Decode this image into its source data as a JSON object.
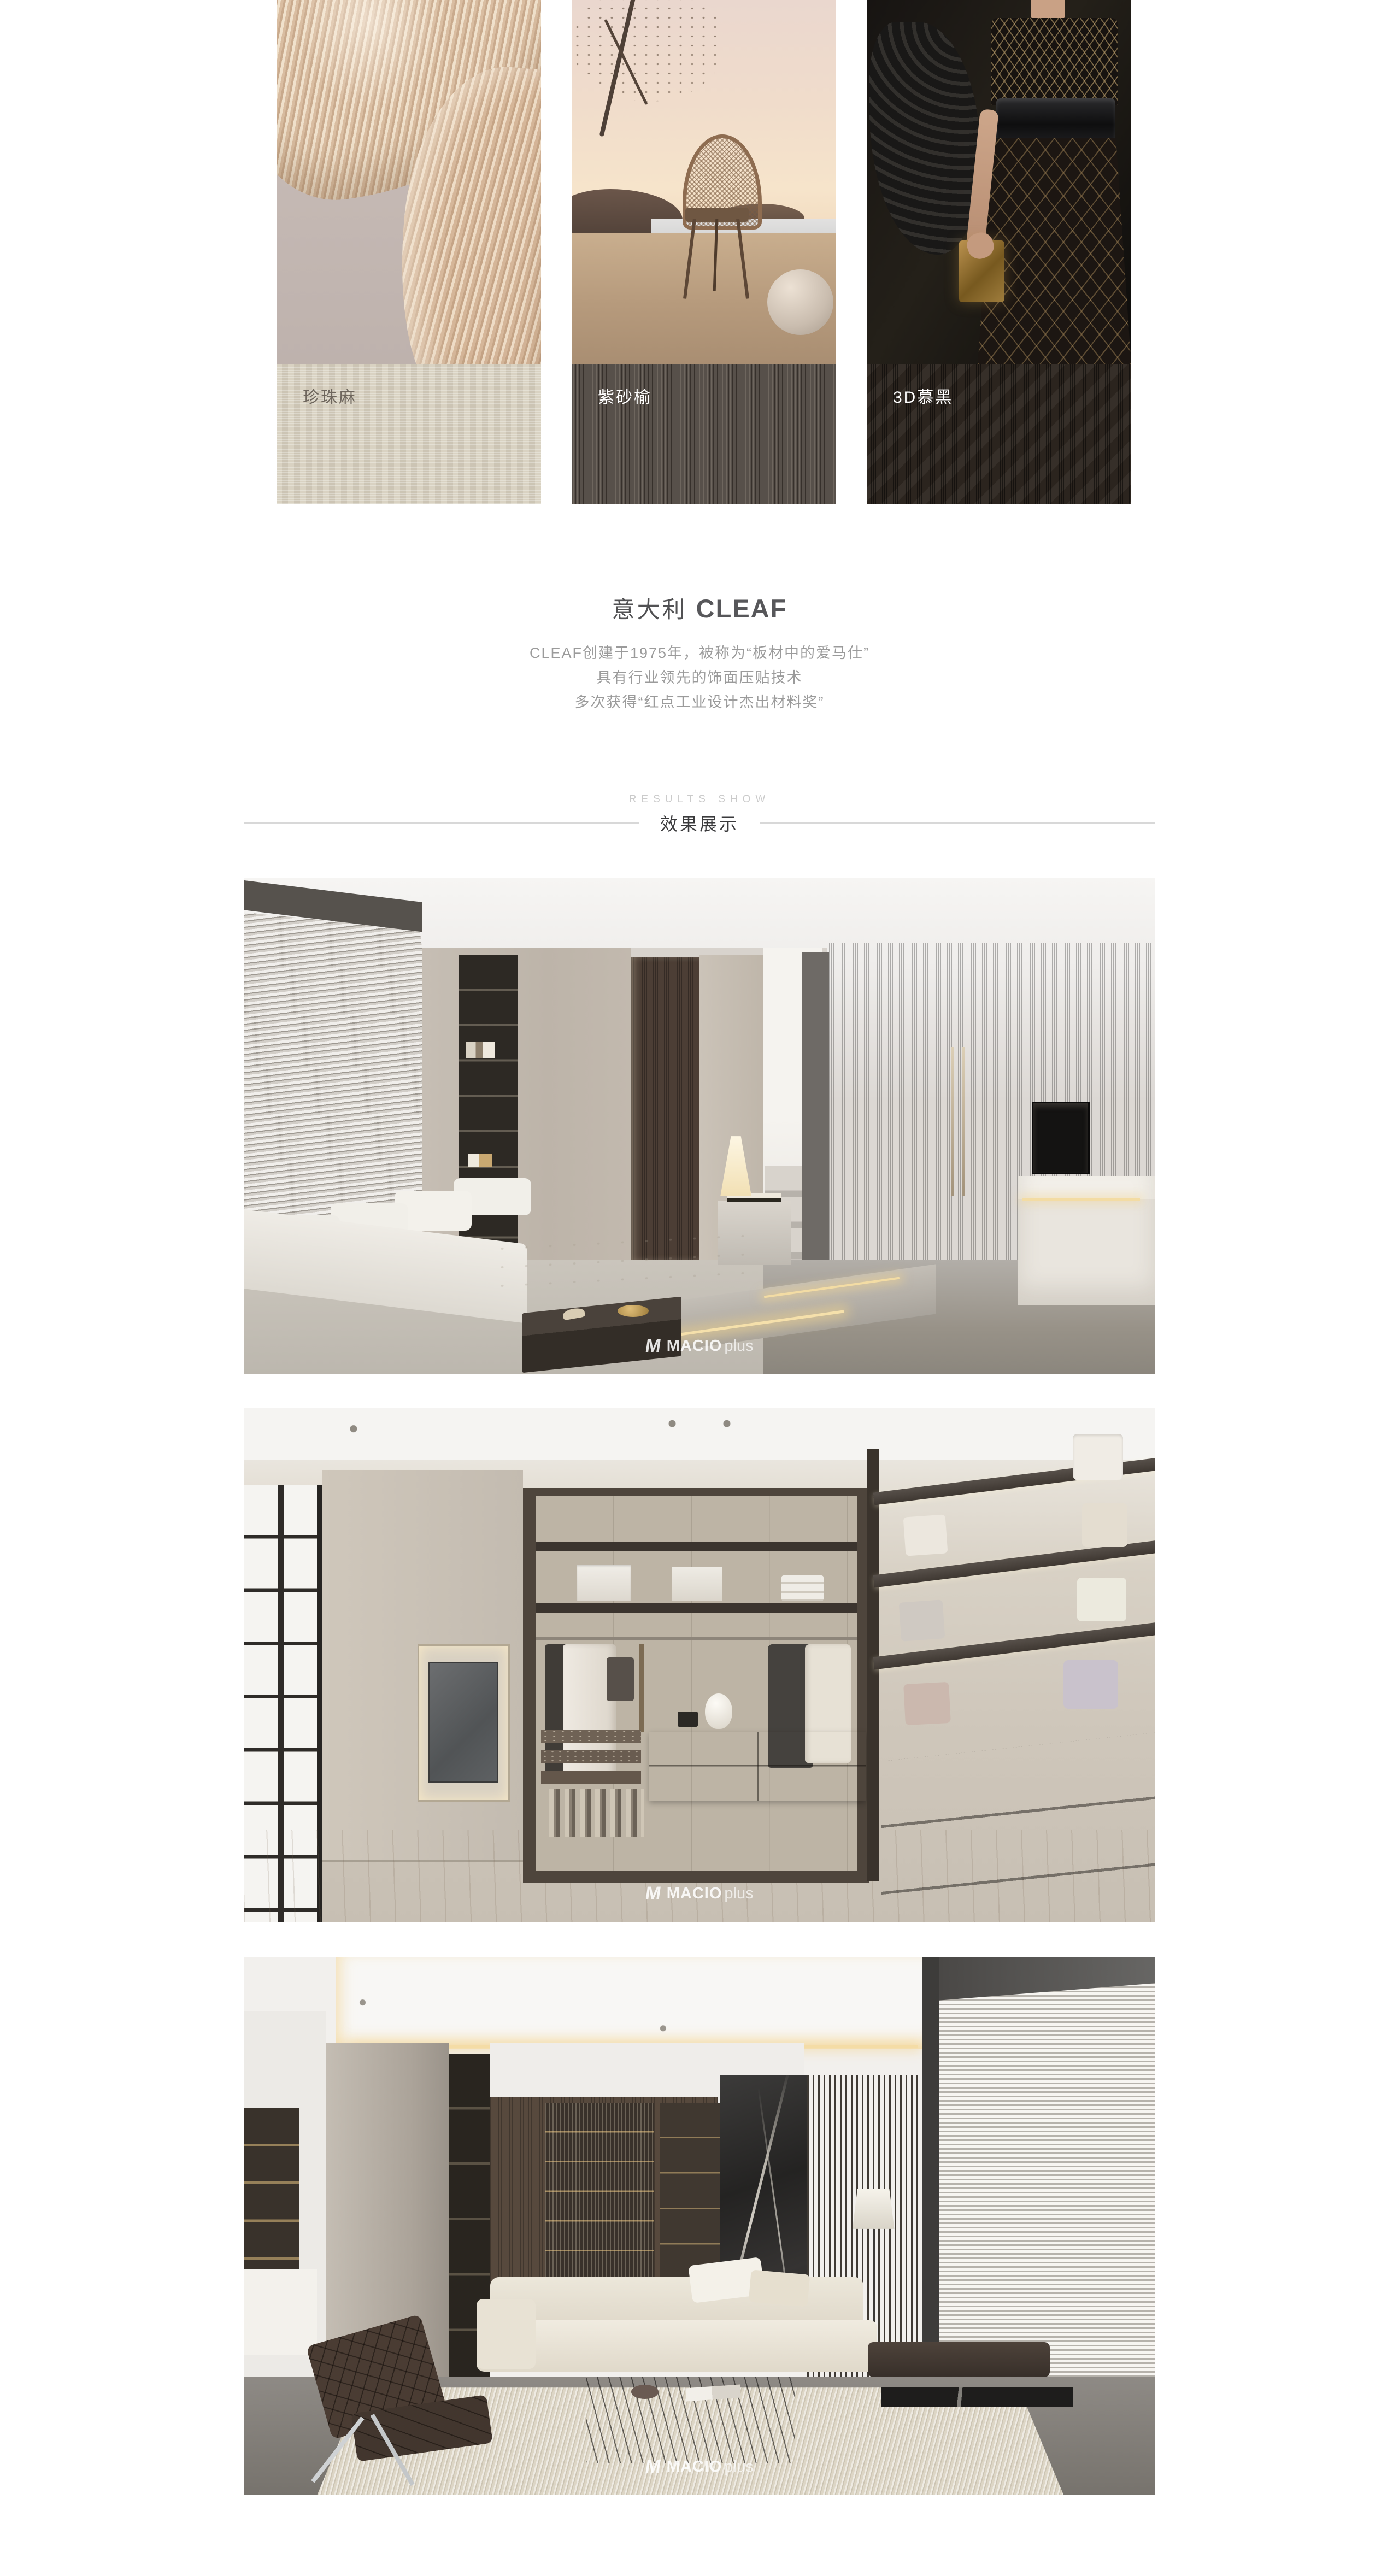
{
  "materials": {
    "cards": [
      {
        "label": "珍珠麻"
      },
      {
        "label": "紫砂榆"
      },
      {
        "label": "3D慕黑"
      }
    ]
  },
  "brand_intro": {
    "region": "意大利",
    "brand": "CLEAF",
    "lines": [
      "CLEAF创建于1975年，被称为“板材中的爱马仕”",
      "具有行业领先的饰面压贴技术",
      "多次获得“红点工业设计杰出材料奖”"
    ]
  },
  "results": {
    "eyebrow": "RESULTS SHOW",
    "title": "效果展示"
  },
  "watermark": {
    "logo": "M",
    "name": "MACIO",
    "suffix": "plus"
  },
  "colors": {
    "page_bg": "#ffffff",
    "heading_text": "#57575a",
    "body_text": "#9b9b9b",
    "eyebrow_text": "#cbcbcb",
    "section_title_text": "#3a3a3c",
    "divider": "#d8d8d8",
    "swatch_pearl_linen": "#d9d2c2",
    "swatch_zisha_elm": "#57504a",
    "swatch_3d_black": "#2b241e",
    "led_glow": "#f0d9a4"
  }
}
